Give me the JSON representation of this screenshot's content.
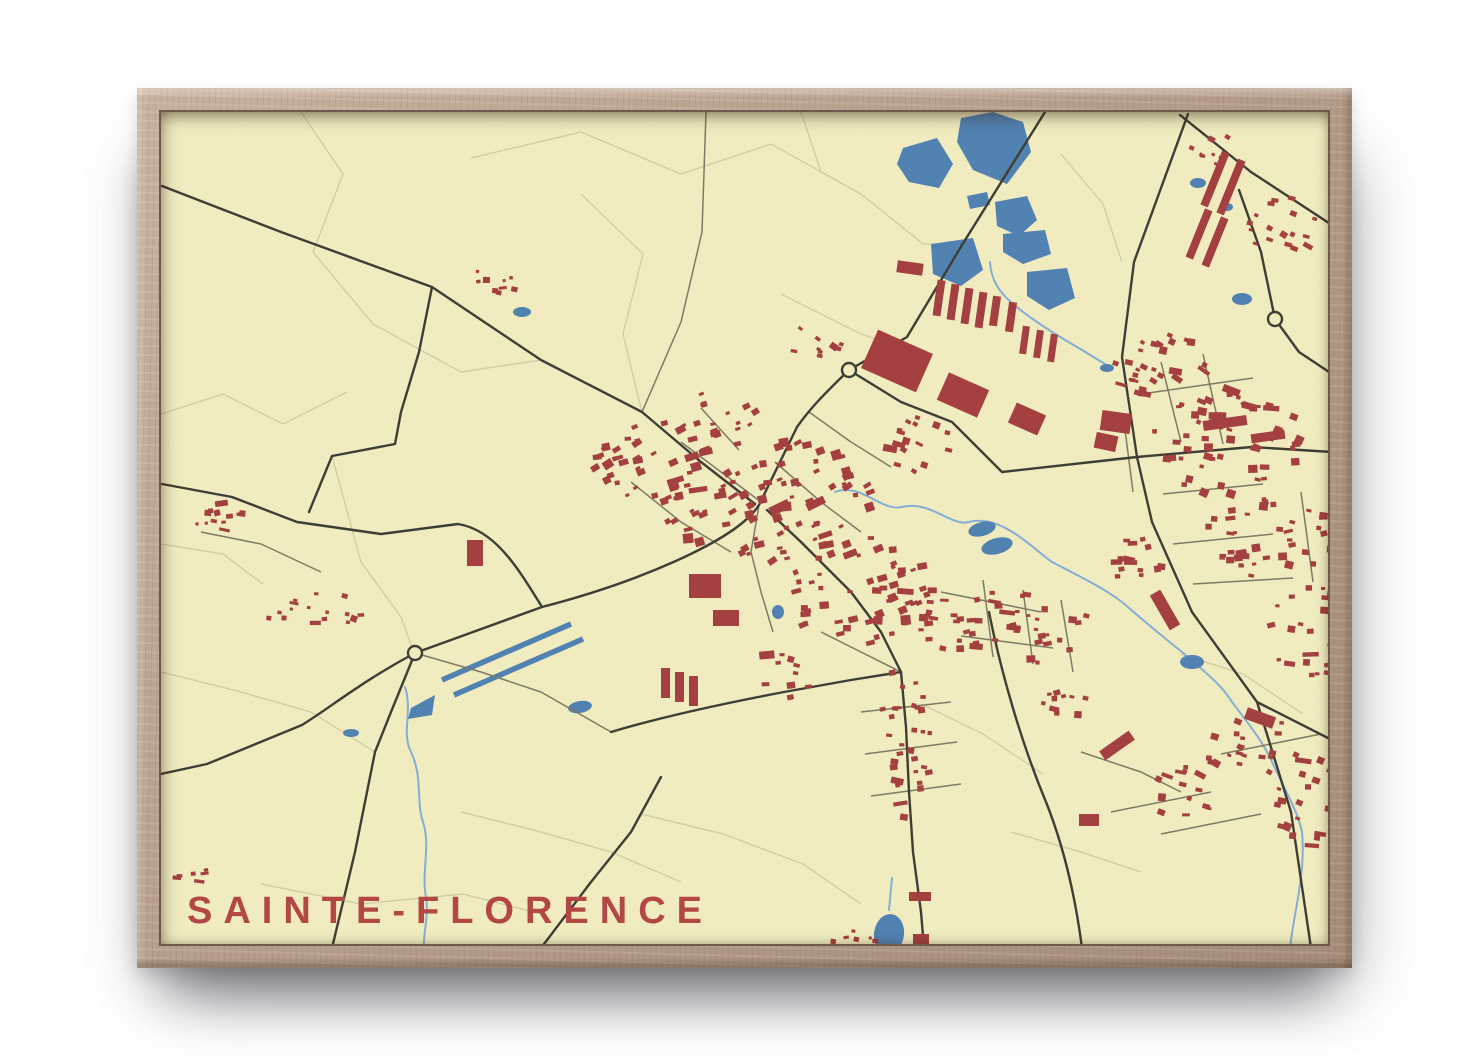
{
  "poster": {
    "title": "SAINTE-FLORENCE"
  },
  "colors": {
    "page_bg": "#ffffff",
    "cream": "#f2eec1",
    "frame_wood": "#b79d8b",
    "frame_lip": "#6e594c",
    "road_main": "#3a3a31",
    "road_secondary": "#7a7a62",
    "field_line": "#ccc8a0",
    "water_line": "#84aed6",
    "water_fill": "#4e80b2",
    "building": "#a43c3c",
    "title": "#b24743"
  },
  "map_data": {
    "canvas": {
      "width": 1171,
      "height": 836
    },
    "roads_main": [
      "M884,0 L801,133 746,225 688,258 C660,285 648,298 636,315 L598,393 C575,430 470,472 381,495 L254,541 C200,570 170,595 141,613 L46,652 0,662",
      "M1,74 L120,120 271,175 380,248 481,300 540,350 594,392",
      "M254,541 L230,600 214,640 194,740 171,836",
      "M606,398 L640,430 690,480 720,520 740,560 745,615 748,680 752,740 760,800 763,836",
      "M1027,2 L973,150 961,245 976,345 991,410 1031,500 1096,590 1130,700 1150,836",
      "M1019,3 L1090,60 1171,113",
      "M1078,78 L1100,140 1114,207",
      "M1114,207 L1138,240 1171,262",
      "M841,360 L976,345 1091,335 1171,340",
      "M828,500 C840,560 860,630 885,690 C905,740 915,790 921,836",
      "M1096,590 L1171,628",
      "M450,620 C500,605 560,592 623,580 L690,568 740,560",
      "M688,258 L740,290 791,310 841,360",
      "M380,836 L430,770 470,720 500,665",
      "M1,372 L71,385 136,410 220,422 297,412 C335,418 358,458 381,495",
      "M271,175 L258,240 240,300 234,332 171,344 148,400"
    ],
    "roads_secondary": [
      "M481,300 L520,210 541,120 545,0",
      "M40,420 L100,432 160,460",
      "M254,541 L320,560 380,580 450,620",
      "M520,330 L560,360 600,390",
      "M540,296 L578,338",
      "M470,370 L520,410 570,440",
      "M614,350 L660,390 700,420",
      "M648,300 L690,330 730,355",
      "M780,480 L880,500",
      "M800,524 L892,536",
      "M822,468 L832,545",
      "M862,478 L872,552",
      "M900,488 L912,560",
      "M700,600 L790,590",
      "M704,642 L796,630",
      "M710,684 L800,672",
      "M1000,250 L1020,330",
      "M1042,242 L1062,332",
      "M980,282 L1092,266",
      "M1002,382 L1102,372",
      "M1012,432 L1112,422",
      "M1032,472 L1132,466",
      "M962,302 L972,380",
      "M1140,380 L1152,470",
      "M950,700 L1050,680",
      "M1000,722 L1100,702",
      "M1060,642 L1160,622",
      "M920,640 L980,660 1020,680",
      "M598,393 L590,440 600,480 612,520",
      "M660,520 L700,540 740,560"
    ],
    "field_lines": [
      "M140,0 L182,62 152,140 212,212",
      "M310,46 L420,20 520,62 610,32 700,82",
      "M0,302 L62,282 122,312 186,280",
      "M420,82 L482,142 462,222 481,300",
      "M700,82 L762,132 801,133",
      "M0,432 L62,442 102,472",
      "M100,772 L200,792 302,782 380,802",
      "M480,702 L562,722 642,752 700,792",
      "M760,592 L822,622 882,662",
      "M1020,542 L1082,562 1142,602",
      "M900,42 L942,92 961,150",
      "M620,182 L700,222 760,242",
      "M212,212 L300,260 380,248",
      "M0,560 L80,580 150,600 214,640",
      "M300,700 L380,720 450,740 520,770",
      "M850,720 L920,740 980,760",
      "M640,0 L660,60 700,82",
      "M171,344 L200,450 240,505 252,538"
    ],
    "streams": [
      "M674,380 C700,370 720,400 741,395 C770,388 790,415 808,410 C840,402 870,435 891,450 C930,470 945,478 961,490 C990,515 1002,525 1021,540 C1050,565 1062,575 1071,590 C1090,615 1102,630 1111,650 C1125,680 1137,700 1141,720 C1145,760 1133,800 1129,836",
      "M244,575 C252,600 240,620 250,640 C262,665 255,690 262,710 C270,735 260,760 265,785 C268,805 262,820 263,836",
      "M829,150 C830,168 838,180 852,192 C870,207 890,220 916,235 L944,252",
      "M731,766 L728,798"
    ],
    "canal_stripes": [
      "M281,568 L410,512",
      "M293,583 L422,527"
    ],
    "water_polygons": [
      "800,6 832,0 862,10 870,40 846,72 812,58 796,30",
      "742,36 776,26 792,52 778,76 748,70 736,52",
      "834,90 866,84 876,108 858,124 836,114",
      "842,122 884,118 890,142 862,152 842,140",
      "770,132 812,126 822,158 800,174 772,162",
      "866,160 906,156 914,186 888,198 866,184",
      "806,84 826,80 829,93 809,97",
      "250,596 274,583 271,603 247,607"
    ],
    "ponds": [
      [
        1037,
        71,
        8,
        5,
        0
      ],
      [
        1081,
        187,
        10,
        6,
        0
      ],
      [
        1066,
        95,
        6,
        4,
        0
      ],
      [
        821,
        417,
        14,
        7,
        -15
      ],
      [
        836,
        434,
        16,
        8,
        -15
      ],
      [
        1031,
        550,
        12,
        7,
        0
      ],
      [
        617,
        500,
        6,
        7,
        0
      ],
      [
        361,
        200,
        9,
        5,
        0
      ],
      [
        190,
        621,
        8,
        4,
        0
      ],
      [
        419,
        595,
        12,
        6,
        -10
      ],
      [
        728,
        822,
        15,
        20,
        8
      ],
      [
        946,
        256,
        7,
        4,
        0
      ]
    ],
    "roundabouts": [
      [
        688,
        258
      ],
      [
        254,
        541
      ],
      [
        1114,
        207
      ]
    ],
    "building_clusters": [
      {
        "cx": 610,
        "cy": 390,
        "rx": 115,
        "ry": 62,
        "n": 85,
        "smin": 4,
        "smax": 11,
        "rot": -20
      },
      {
        "cx": 700,
        "cy": 480,
        "rx": 72,
        "ry": 55,
        "n": 55,
        "smin": 4,
        "smax": 10,
        "rot": -10
      },
      {
        "cx": 845,
        "cy": 518,
        "rx": 88,
        "ry": 42,
        "n": 48,
        "smin": 4,
        "smax": 9,
        "rot": 0
      },
      {
        "cx": 745,
        "cy": 630,
        "rx": 26,
        "ry": 85,
        "n": 30,
        "smin": 4,
        "smax": 8,
        "rot": 0
      },
      {
        "cx": 495,
        "cy": 350,
        "rx": 68,
        "ry": 40,
        "n": 40,
        "smin": 4,
        "smax": 10,
        "rot": -20
      },
      {
        "cx": 560,
        "cy": 300,
        "rx": 35,
        "ry": 25,
        "n": 14,
        "smin": 4,
        "smax": 8,
        "rot": -20
      },
      {
        "cx": 60,
        "cy": 402,
        "rx": 30,
        "ry": 20,
        "n": 12,
        "smin": 3,
        "smax": 7,
        "rot": 0
      },
      {
        "cx": 152,
        "cy": 495,
        "rx": 55,
        "ry": 20,
        "n": 16,
        "smin": 3,
        "smax": 7,
        "rot": 10
      },
      {
        "cx": 25,
        "cy": 762,
        "rx": 22,
        "ry": 14,
        "n": 8,
        "smin": 3,
        "smax": 6,
        "rot": 0
      },
      {
        "cx": 1070,
        "cy": 330,
        "rx": 78,
        "ry": 55,
        "n": 58,
        "smin": 4,
        "smax": 10,
        "rot": 10
      },
      {
        "cx": 1115,
        "cy": 425,
        "rx": 70,
        "ry": 42,
        "n": 42,
        "smin": 4,
        "smax": 9,
        "rot": 0
      },
      {
        "cx": 1005,
        "cy": 255,
        "rx": 55,
        "ry": 32,
        "n": 28,
        "smin": 4,
        "smax": 8,
        "rot": 20
      },
      {
        "cx": 1155,
        "cy": 520,
        "rx": 58,
        "ry": 48,
        "n": 32,
        "smin": 4,
        "smax": 9,
        "rot": 0
      },
      {
        "cx": 1165,
        "cy": 690,
        "rx": 58,
        "ry": 45,
        "n": 32,
        "smin": 4,
        "smax": 9,
        "rot": 15
      },
      {
        "cx": 1090,
        "cy": 635,
        "rx": 48,
        "ry": 32,
        "n": 22,
        "smin": 4,
        "smax": 8,
        "rot": 15
      },
      {
        "cx": 1125,
        "cy": 115,
        "rx": 42,
        "ry": 30,
        "n": 18,
        "smin": 4,
        "smax": 8,
        "rot": 20
      },
      {
        "cx": 1058,
        "cy": 38,
        "rx": 30,
        "ry": 18,
        "n": 9,
        "smin": 3,
        "smax": 7,
        "rot": 20
      },
      {
        "cx": 700,
        "cy": 828,
        "rx": 28,
        "ry": 12,
        "n": 7,
        "smin": 3,
        "smax": 7,
        "rot": 0
      },
      {
        "cx": 341,
        "cy": 165,
        "rx": 26,
        "ry": 18,
        "n": 9,
        "smin": 3,
        "smax": 7,
        "rot": 0
      },
      {
        "cx": 612,
        "cy": 565,
        "rx": 40,
        "ry": 25,
        "n": 10,
        "smin": 4,
        "smax": 9,
        "rot": 0
      },
      {
        "cx": 905,
        "cy": 585,
        "rx": 30,
        "ry": 20,
        "n": 10,
        "smin": 4,
        "smax": 8,
        "rot": 0
      },
      {
        "cx": 972,
        "cy": 448,
        "rx": 35,
        "ry": 25,
        "n": 14,
        "smin": 4,
        "smax": 8,
        "rot": 0
      },
      {
        "cx": 760,
        "cy": 330,
        "rx": 40,
        "ry": 30,
        "n": 16,
        "smin": 4,
        "smax": 9,
        "rot": 24
      },
      {
        "cx": 660,
        "cy": 230,
        "rx": 30,
        "ry": 22,
        "n": 10,
        "smin": 4,
        "smax": 8,
        "rot": 24
      },
      {
        "cx": 1020,
        "cy": 680,
        "rx": 40,
        "ry": 25,
        "n": 14,
        "smin": 4,
        "smax": 8,
        "rot": 15
      }
    ],
    "large_buildings": [
      [
        706,
        228,
        60,
        42,
        24
      ],
      [
        780,
        268,
        44,
        30,
        24
      ],
      [
        850,
        296,
        32,
        22,
        24
      ],
      [
        774,
        168,
        8,
        36,
        8
      ],
      [
        788,
        172,
        8,
        36,
        8
      ],
      [
        802,
        176,
        8,
        36,
        8
      ],
      [
        816,
        180,
        8,
        36,
        8
      ],
      [
        830,
        184,
        8,
        30,
        8
      ],
      [
        846,
        190,
        8,
        30,
        8
      ],
      [
        860,
        214,
        7,
        28,
        8
      ],
      [
        874,
        218,
        7,
        28,
        8
      ],
      [
        888,
        222,
        7,
        28,
        8
      ],
      [
        736,
        150,
        26,
        12,
        8
      ],
      [
        940,
        300,
        30,
        20,
        8
      ],
      [
        1042,
        306,
        44,
        10,
        -8
      ],
      [
        1090,
        320,
        34,
        9,
        -8
      ],
      [
        1050,
        38,
        8,
        58,
        22
      ],
      [
        1066,
        46,
        8,
        58,
        22
      ],
      [
        1034,
        96,
        8,
        52,
        22
      ],
      [
        1050,
        104,
        8,
        52,
        22
      ],
      [
        528,
        462,
        32,
        24,
        0
      ],
      [
        552,
        498,
        26,
        16,
        0
      ],
      [
        500,
        556,
        9,
        30,
        0
      ],
      [
        514,
        560,
        9,
        30,
        0
      ],
      [
        528,
        564,
        9,
        30,
        0
      ],
      [
        306,
        428,
        16,
        26,
        0
      ],
      [
        934,
        322,
        22,
        16,
        12
      ],
      [
        998,
        478,
        12,
        40,
        -30
      ],
      [
        938,
        628,
        36,
        11,
        -35
      ],
      [
        748,
        780,
        22,
        9,
        0
      ],
      [
        752,
        822,
        16,
        10,
        0
      ],
      [
        1084,
        600,
        30,
        12,
        20
      ],
      [
        918,
        702,
        20,
        12,
        0
      ]
    ]
  }
}
